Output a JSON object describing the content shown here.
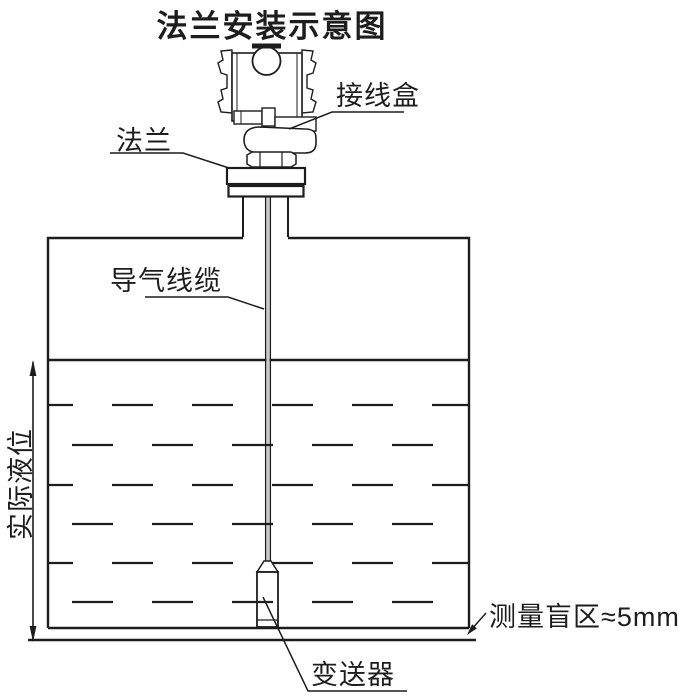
{
  "title": "法兰安装示意图",
  "labels": {
    "junction_box": "接线盒",
    "flange": "法兰",
    "air_cable": "导气线缆",
    "actual_level": "实际液位",
    "transmitter": "变送器",
    "blind_zone": "测量盲区≈5mm"
  },
  "colors": {
    "ink": "#1d1d1d",
    "background": "#ffffff",
    "cable_core_gray": "#c9c9c9"
  }
}
